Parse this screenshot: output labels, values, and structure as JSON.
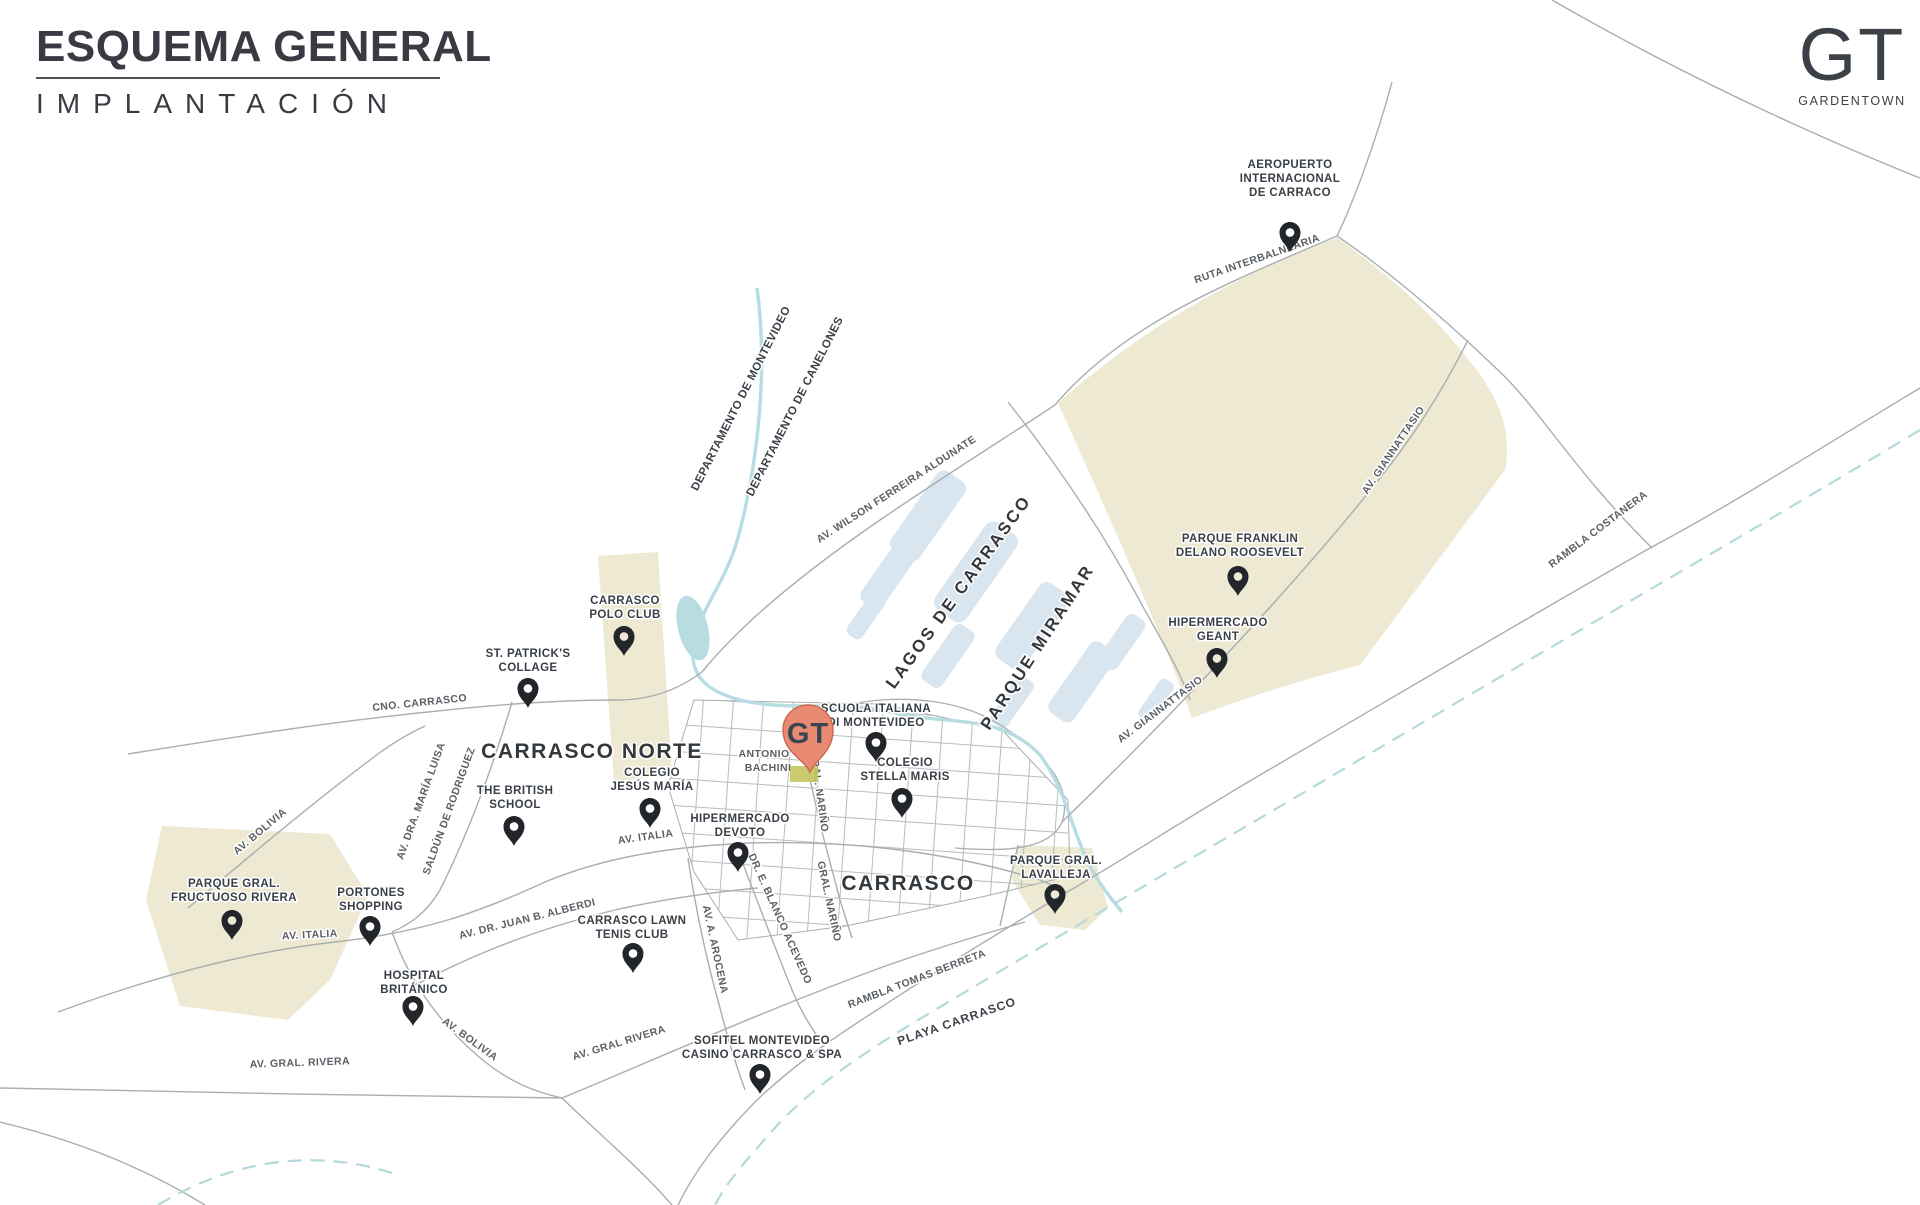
{
  "header": {
    "title_line1": "ESQUEMA GENERAL",
    "title_line2": "IMPLANTACIÓN"
  },
  "logo": {
    "initials": "GT",
    "name": "GARDENTOWN"
  },
  "colors": {
    "accent_pin": "#E98A72",
    "pin": "#22262B",
    "park": "#EDE9D3",
    "water": "#D9E6EF",
    "stream": "#B7DCE2",
    "road": "#A9AEAE",
    "site": "#C6C45E"
  },
  "site_marker": {
    "label": "GT"
  },
  "districts": {
    "lagos": "LAGOS DE CARRASCO",
    "miramar": "PARQUE MIRAMAR",
    "carrasco_norte": "CARRASCO NORTE",
    "carrasco": "CARRASCO",
    "playa": "PLAYA CARRASCO"
  },
  "boundaries": {
    "montevideo": "DEPARTAMENTO DE MONTEVIDEO",
    "canelones": "DEPARTAMENTO DE CANELONES"
  },
  "roads": {
    "ruta_interbalnearia": "RUTA INTERBALNEARIA",
    "giannattasio": "AV. GIANNATTASIO",
    "rambla_costanera": "RAMBLA COSTANERA",
    "wilson_ferreira": "AV. WILSON FERREIRA ALDUNATE",
    "cno_carrasco": "CNO. CARRASCO",
    "saldun_1": "AV. DRA. MARÍA LUISA",
    "saldun_2": "SALDÚN DE RODRIGUEZ",
    "bachini_1": "ANTONIO",
    "bachini_2": "BACHINI",
    "gral_narino": "GRAL. NARIÑO",
    "av_italia": "AV. ITALIA",
    "alberdi": "AV. DR. JUAN B. ALBERDI",
    "arocena": "AV. A. AROCENA",
    "blanco_acevedo": "DR. E. BLANCO ACEVEDO",
    "bolivia": "AV. BOLIVIA",
    "gral_rivera": "AV. GRAL RIVERA",
    "gral_rivera_dot": "AV. GRAL. RIVERA",
    "tomas_berreta": "RAMBLA TOMAS BERRETA"
  },
  "pois": [
    {
      "id": "aeropuerto",
      "lines": [
        "AEROPUERTO",
        "INTERNACIONAL",
        "DE CARRACO"
      ]
    },
    {
      "id": "parque-roosevelt",
      "lines": [
        "PARQUE FRANKLIN",
        "DELANO ROOSEVELT"
      ]
    },
    {
      "id": "hipermercado-geant",
      "lines": [
        "HIPERMERCADO",
        "GEANT"
      ]
    },
    {
      "id": "carrasco-polo-club",
      "lines": [
        "CARRASCO",
        "POLO CLUB"
      ]
    },
    {
      "id": "st-patricks",
      "lines": [
        "ST. PATRICK'S",
        "COLLAGE"
      ]
    },
    {
      "id": "scuola-italiana",
      "lines": [
        "SCUOLA ITALIANA",
        "DI MONTEVIDEO"
      ]
    },
    {
      "id": "colegio-stella-maris",
      "lines": [
        "COLEGIO",
        "STELLA MARIS"
      ]
    },
    {
      "id": "the-british-school",
      "lines": [
        "THE BRITISH",
        "SCHOOL"
      ]
    },
    {
      "id": "colegio-jesus-maria",
      "lines": [
        "COLEGIO",
        "JESÚS MARÍA"
      ]
    },
    {
      "id": "hipermercado-devoto",
      "lines": [
        "HIPERMERCADO",
        "DEVOTO"
      ]
    },
    {
      "id": "parque-fructuoso-rivera",
      "lines": [
        "PARQUE GRAL.",
        "FRUCTUOSO RIVERA"
      ]
    },
    {
      "id": "portones-shopping",
      "lines": [
        "PORTONES",
        "SHOPPING"
      ]
    },
    {
      "id": "carrasco-lawn-tenis",
      "lines": [
        "CARRASCO LAWN",
        "TENIS CLUB"
      ]
    },
    {
      "id": "hospital-britanico",
      "lines": [
        "HOSPITAL",
        "BRITÁNICO"
      ]
    },
    {
      "id": "sofitel",
      "lines": [
        "SOFITEL MONTEVIDEO",
        "CASINO CARRASCO & SPA"
      ]
    },
    {
      "id": "parque-lavalleja",
      "lines": [
        "PARQUE GRAL.",
        "LAVALLEJA"
      ]
    }
  ]
}
